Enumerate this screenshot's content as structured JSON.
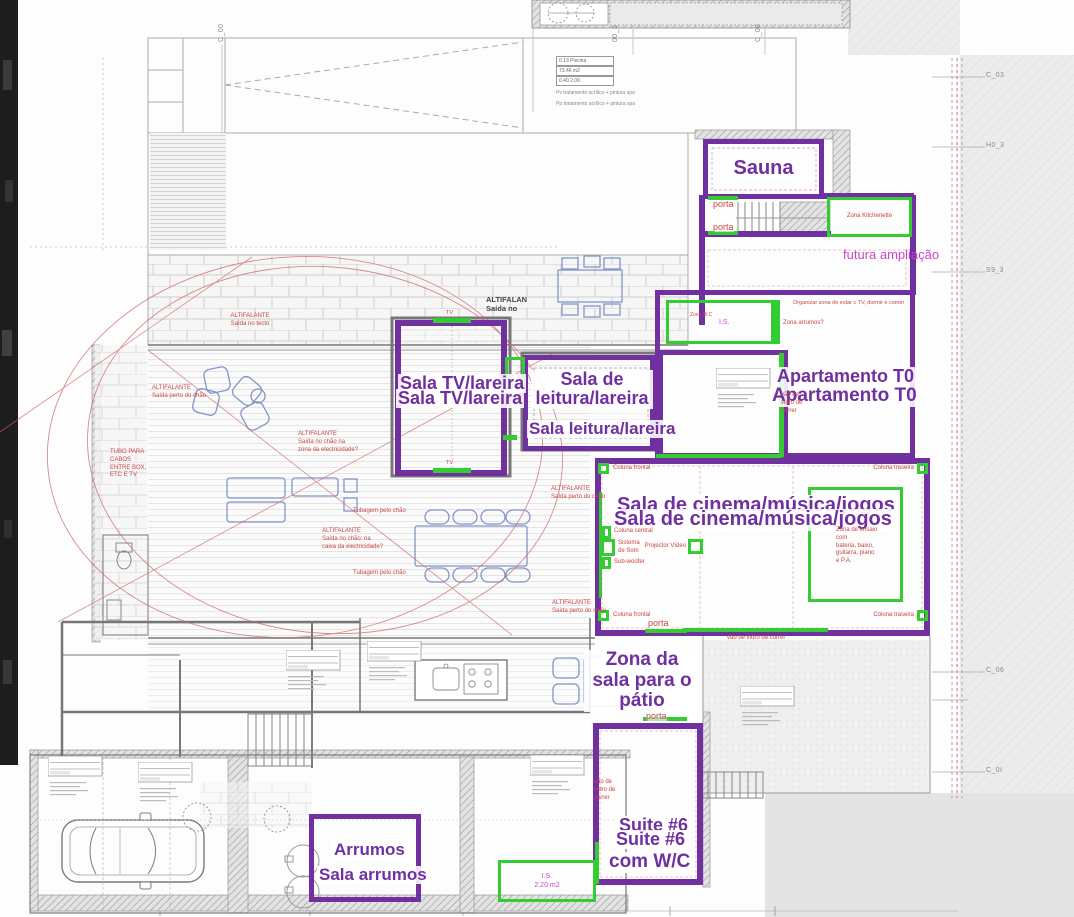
{
  "title": "Planta piso - anotações de zonas",
  "colors": {
    "purple_outline": "#7030a0",
    "green_outline": "#33cc33",
    "red_note": "#c94545",
    "magenta_note": "#cc44cc",
    "furniture_blue": "#8494c8"
  },
  "rooms": {
    "sauna": "Sauna",
    "sala_tv": "Sala TV/lareira",
    "sala_leitura_wrap": "Sala de leitura/lareira",
    "sala_leitura": "Sala leitura/lareira",
    "apartamento": "Apartamento T0",
    "cinema": "Sala de cinema/música/jogos",
    "zona_sala": "Zona da sala para o pátio",
    "suite": "Suite #6",
    "suite_wc": "com W/C",
    "arrumos": "Arrumos",
    "sala_arrumos": "Sala arrumos",
    "futura": "futura ampliação"
  },
  "tags": {
    "kitchenette": "Zona Kitchenette",
    "zona_wc": "Zona W.C",
    "is": "I.S.",
    "is_area": "2.20 m2",
    "ensaio": "Zona de ensaio\ncom\nbateria, baixo,\nguitarra, piano\ne P.A."
  },
  "notes": {
    "alt_tecto": "ALTIFALANTE\nSaída no tecto",
    "alt_perto": "ALTIFALANTE\nSaída perto do chão",
    "alt_zona": "ALTIFALANTE\nSaída no chão na\nzona da electricidade?",
    "alt_caixa": "ALTIFALANTE\nSaída no chão: na\ncaixa da electricidade?",
    "alt_saida": "ALTIFALAN\nSaída no",
    "tubo": "TUBO PARA\nCABOS\nENTRE BOX,\nETC E TV",
    "tubagem": "Tubagem pelo chão",
    "organizar": "Organizar zona de estar c TV, dormir e comer",
    "zona_arrumos": "Zona arrumos?",
    "porta": "porta",
    "vao_h": "vão de vidro de correr",
    "vao_v": "vão de\nvidro de\ncorrer",
    "coluna_frontal": "Coluna frontal",
    "coluna_traseira": "Coluna traseira",
    "coluna_central": "Coluna central",
    "sistema_som": "Sistema\nde Som",
    "subwoofer": "Sub-woofer",
    "projector": "Projector Vídeo",
    "tv": "TV"
  },
  "pool": {
    "l1": "0.13 Piscina",
    "l2": "73.46 m2",
    "l3": "0.40  2.00",
    "n1": "Pv  tratamento acrílico + pintura spa",
    "n2": "Pp  tratamento acrílico + pintura spa"
  },
  "refs": {
    "right": [
      {
        "label": "C_03"
      },
      {
        "label": "H0_3"
      },
      {
        "label": "S9_3"
      },
      {
        "label": "C_06"
      },
      {
        "label": "C_0I"
      }
    ],
    "top": [
      {
        "label": "C_00"
      },
      {
        "label": "00_3"
      },
      {
        "label": "C_08"
      }
    ]
  }
}
